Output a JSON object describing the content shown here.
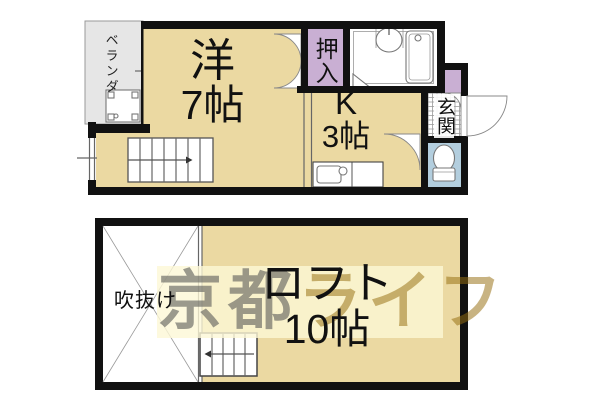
{
  "floor1": {
    "veranda": "ベランダ",
    "room": "洋",
    "room_size": "7帖",
    "closet": "押入",
    "kitchen": "K",
    "kitchen_size": "3帖",
    "entrance": "玄関"
  },
  "loft": {
    "name": "ロフト",
    "size": "10帖",
    "void": "吹抜け"
  },
  "watermark": {
    "city": "京都",
    "brand": "ライフ"
  },
  "colors": {
    "room_fill": "#EBD9A2",
    "closet_fill": "#C9AFD3",
    "toilet_fill": "#B3CEDE",
    "veranda_fill": "#E6E6E6",
    "wall": "#111111",
    "watermark_band": "#F8F0CA",
    "watermark_city": "#9C9A91",
    "watermark_brand": "#CDB377"
  },
  "icons": [
    "washing-machine-icon",
    "window-icon",
    "stairs-up-icon",
    "stairs-down-icon",
    "double-door-icon",
    "washbasin-icon",
    "bathtub-icon",
    "kitchen-sink-icon",
    "toilet-icon",
    "door-swing-icon",
    "void-cross-icon",
    "entrance-tile-icon"
  ]
}
